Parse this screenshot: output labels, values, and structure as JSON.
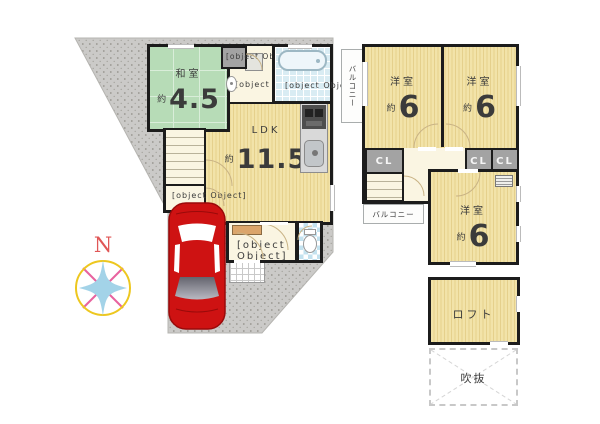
{
  "compass": {
    "north": "N"
  },
  "floor1": {
    "washitsu": {
      "name": "和室",
      "approx": "約",
      "size": "4.5"
    },
    "oshiire": {
      "name": "押入"
    },
    "senmenjo": {
      "name": "洗面所"
    },
    "yokushitsu": {
      "name": "浴室"
    },
    "ldk": {
      "name": "LDK",
      "approx": "約",
      "size": "11.5"
    },
    "monoire": {
      "name": "物入"
    },
    "genkan": {
      "name": "玄関"
    }
  },
  "floor2": {
    "balcony_left": "バルコニー",
    "balcony_bottom": "バルコニー",
    "bedroom1": {
      "name": "洋室",
      "approx": "約",
      "size": "6"
    },
    "bedroom2": {
      "name": "洋室",
      "approx": "約",
      "size": "6"
    },
    "bedroom3": {
      "name": "洋室",
      "approx": "約",
      "size": "6"
    },
    "cl1": "CL",
    "cl2": "CL",
    "cl3": "CL"
  },
  "loft": {
    "name": "ロフト"
  },
  "void": {
    "name": "吹抜"
  },
  "colors": {
    "wall": "#1c1c1c",
    "wood_floor": "#f0e0a2",
    "tatami_green": "#b7dcb7",
    "hall_cream": "#faf5e2",
    "closet_gray": "#a3a3a3",
    "lot_gray": "#cbcac8",
    "bath_blue": "#d9ecf3",
    "car_red": "#ce1212",
    "compass_ring": "#edc71f",
    "compass_cross": "#e8629f",
    "compass_star": "#a3d3e8",
    "north_red": "#e05757"
  }
}
